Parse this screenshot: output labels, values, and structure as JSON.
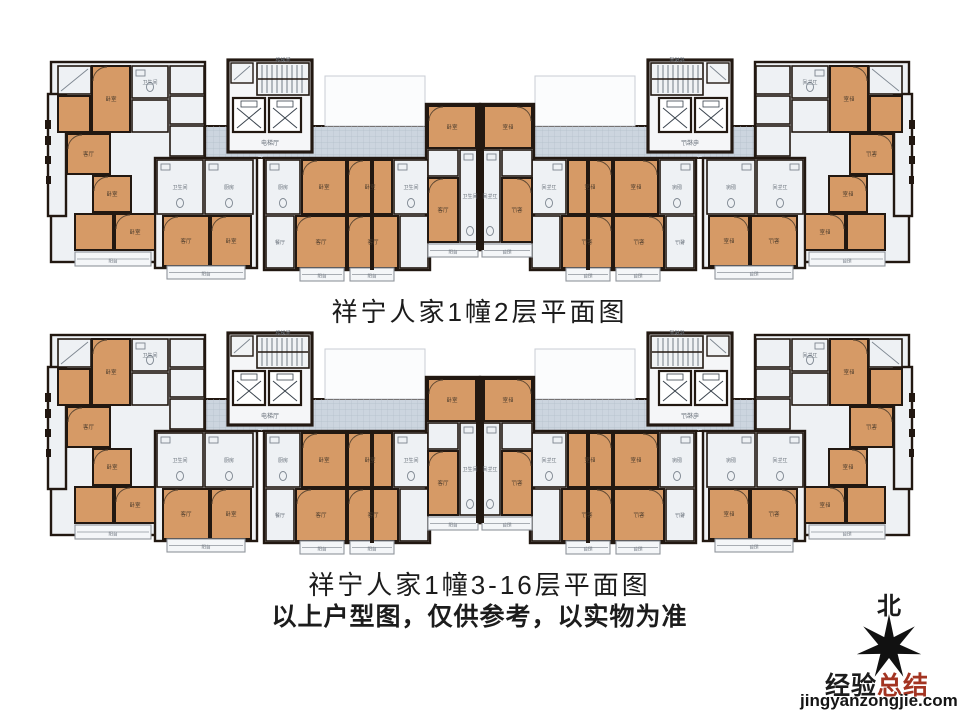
{
  "page": {
    "background": "#ffffff"
  },
  "plans": [
    {
      "title": "祥宁人家1幢2层平面图"
    },
    {
      "title": "祥宁人家1幢3-16层平面图"
    }
  ],
  "disclaimer": "以上户型图，仅供参考，以实物为准",
  "compass": {
    "north_label": "北"
  },
  "watermark": {
    "brand_black": "经验",
    "brand_red": "总结",
    "domain": "jingyanzongjie.com"
  },
  "colors": {
    "room_orange": "#d69a66",
    "room_light": "#eef1f4",
    "core_fill": "#f5f6f8",
    "corridor": "#ccd5df",
    "corridor_grid": "#b4bfca",
    "wall": "#221811",
    "fixture": "#7d8690",
    "balcony_line": "#8f959c",
    "void_line": "#c8cdd4",
    "label_on_orange": "#4a3b2c",
    "label_on_light": "#68707a",
    "brand_red": "#a33422",
    "star_black": "#111111"
  },
  "room_labels": {
    "bedroom": "卧室",
    "living": "客厅",
    "dining": "餐厅",
    "kitchen": "厨房",
    "bath": "卫生间",
    "balcony": "阳台",
    "elevator_hall": "电梯厅",
    "stair": "楼梯间"
  }
}
